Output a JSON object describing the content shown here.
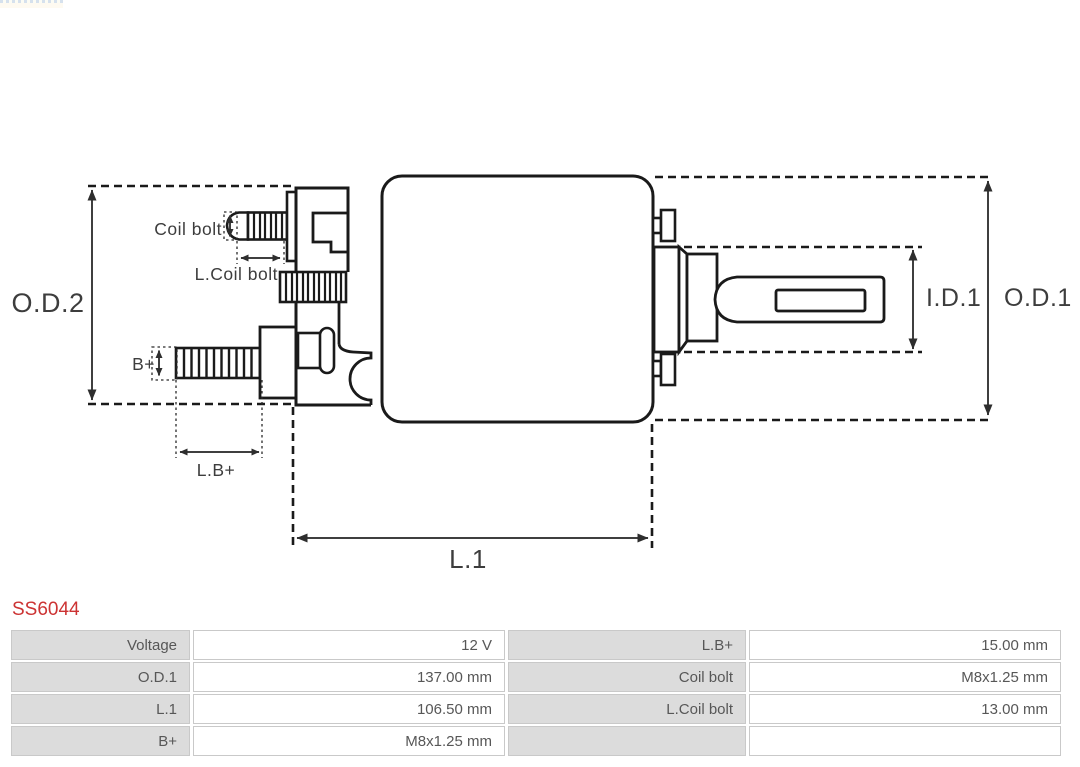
{
  "part_number": "SS6044",
  "diagram": {
    "labels": {
      "od2": "O.D.2",
      "od1": "O.D.1",
      "id1": "I.D.1",
      "l1": "L.1",
      "coil_bolt": "Coil bolt",
      "l_coil_bolt": "L.Coil bolt",
      "b_plus": "B+",
      "l_b_plus": "L.B+"
    }
  },
  "colors": {
    "accent_red": "#cc3333",
    "drawing_line": "#1a1a1a",
    "dimension_line": "#3f3f3f",
    "table_label_bg": "#dcdcdc",
    "table_border": "#c9c9c9",
    "table_text": "#575757"
  },
  "spec_table": {
    "rows": [
      {
        "label_left": "Voltage",
        "value_left": "12 V",
        "label_right": "L.B+",
        "value_right": "15.00 mm"
      },
      {
        "label_left": "O.D.1",
        "value_left": "137.00 mm",
        "label_right": "Coil bolt",
        "value_right": "M8x1.25 mm"
      },
      {
        "label_left": "L.1",
        "value_left": "106.50 mm",
        "label_right": "L.Coil bolt",
        "value_right": "13.00 mm"
      },
      {
        "label_left": "B+",
        "value_left": "M8x1.25 mm",
        "label_right": "",
        "value_right": ""
      }
    ]
  }
}
